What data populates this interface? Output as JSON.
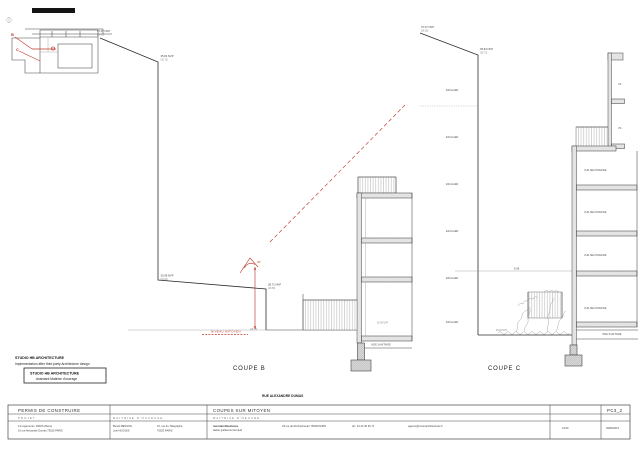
{
  "sheet": {
    "attribution": {
      "line1": "STUDIO HB ARCHITECTURE",
      "line2": "Implementation after third party Architecture design",
      "box_line1": "STUDIO HB ARCHITECTURE",
      "box_line2": "Assistant Maitrise d'ouvrage"
    },
    "street_label": "RUE ALEXANDRE DUMAS"
  },
  "key_plan": {
    "mark_b": "B",
    "mark_c": "C"
  },
  "coupe_b": {
    "label": "COUPE B",
    "levels": {
      "top1": "37.07 NVP",
      "top1b": "(36.95)",
      "top2": "35.84 NVP",
      "top2b": "(35.72)",
      "mid1": "30.08 NVP",
      "mid1b": "(29.96)",
      "mid2": "28.71 NVP",
      "mid2b": "(28.59)",
      "gr1": "27.16 NVP",
      "gr2": "26.95 NVP",
      "gr3": "(26.16)"
    },
    "red_note": "NIVEAU MITOYEN",
    "angle": "45°",
    "vide_sanitaire": "VIDE SANITAIRE"
  },
  "coupe_c": {
    "label": "COUPE C",
    "levels": {
      "top1": "37.07 NVP",
      "top1b": "(36.95)",
      "top2": "35.84 NVP",
      "top2b": "(35.72)",
      "gr1": "26.06 NVP"
    },
    "stair_label": "ESCALIER",
    "room_label": "VUE SECONDAIRE",
    "vs_label": "VS",
    "dim": "6.06",
    "vide_sanitaire": "VIDE SANITAIRE"
  },
  "titleblock": {
    "permit": "PERMIS DE CONSTRUIRE",
    "projet_header": "PROJET",
    "moa_header": "MAITRISE D'OUVRAGE",
    "title": "COUPES SUR MITOYEN",
    "moe_header": "MAITRISE D'OEUVRE",
    "sheet_code": "PC3_2",
    "projet_line1": "14 Logements, PARIS 20ème",
    "projet_line2": "16 rue Alexandre Dumas 75020 PARIS",
    "moa_name1": "Benoit BESSON",
    "moa_name2": "Joel HUGUES",
    "moa_addr1": "16, rue du Télégraphe",
    "moa_addr2": "75020 PARIS",
    "moe_name1": "moonarchitectures",
    "moe_name2": "atelier guillaume bernaud",
    "moe_addr": "33 rue de Rochechouart 75009 PARIS",
    "moe_tel": "tél : 01 42 40 36 71",
    "moe_email": "agence@moonarchitectures.fr",
    "scale": "1/100",
    "date": "09/06/2013"
  }
}
